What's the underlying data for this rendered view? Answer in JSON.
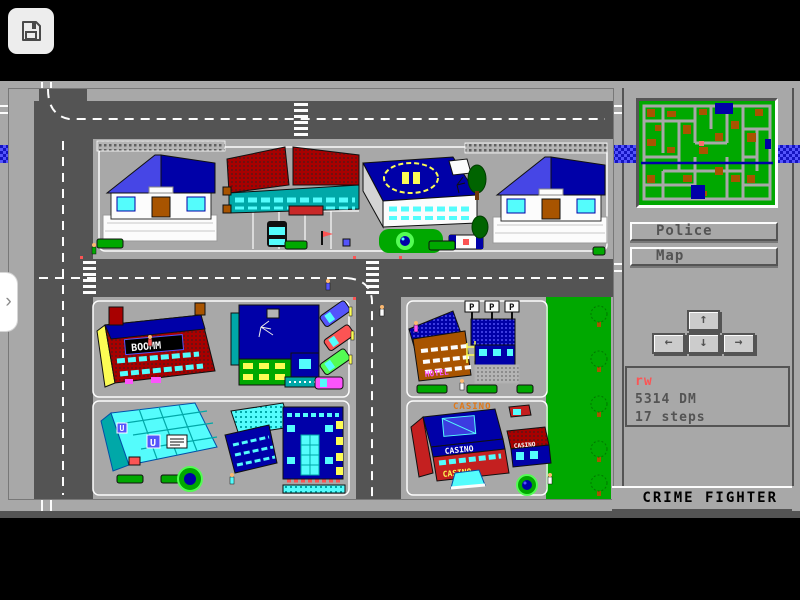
{
  "overlay": {
    "save_icon": "floppy-disk-icon",
    "sidebar_chevron": "›"
  },
  "panel": {
    "police_button": "Police",
    "map_button": "Map",
    "dpad": {
      "up": "↑",
      "left": "←",
      "down": "↓",
      "right": "→"
    },
    "status": {
      "player_name": "rw",
      "money": "5314 DM",
      "steps": "17 steps"
    },
    "brand": "CRIME FIGHTER"
  },
  "city": {
    "labels": {
      "store_sign": "BOOMM",
      "casino_sign": "CASINO",
      "hotel_sign": "HOTEL",
      "parking_p": "P",
      "subway_u": "U"
    }
  },
  "colors": {
    "background": "#000000",
    "ui_gray": "#a8a8a8",
    "road_gray": "#545454",
    "highlight_white": "#fcfcfc",
    "river_blue": "#5454fc",
    "river_blue_dark": "#0000a8",
    "minimap_green": "#00a800",
    "minimap_block_brown": "#a85400",
    "player_marker_pink": "#fc6e6e",
    "status_name_red": "#fc5454",
    "text_dark": "#545454"
  }
}
